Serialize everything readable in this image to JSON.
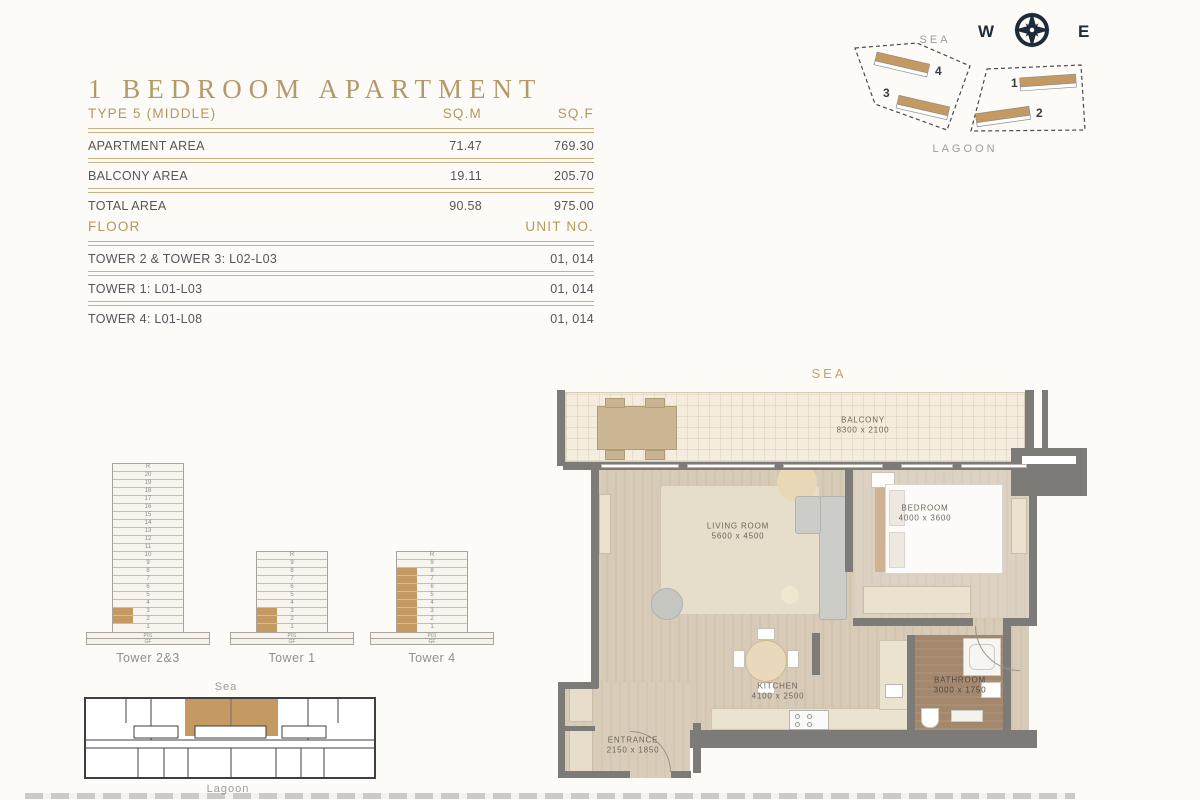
{
  "header": {
    "title": "1 BEDROOM APARTMENT",
    "area_table": {
      "type_label": "TYPE 5 (MIDDLE)",
      "col_sqm": "SQ.M",
      "col_sqf": "SQ.F",
      "rows": [
        {
          "label": "APARTMENT AREA",
          "sqm": "71.47",
          "sqf": "769.30"
        },
        {
          "label": "BALCONY AREA",
          "sqm": "19.11",
          "sqf": "205.70"
        },
        {
          "label": "TOTAL AREA",
          "sqm": "90.58",
          "sqf": "975.00"
        }
      ]
    },
    "floor_table": {
      "col_floor": "FLOOR",
      "col_unit": "UNIT NO.",
      "rows": [
        {
          "floor": "TOWER 2 & TOWER 3: L02-L03",
          "unit": "01, 014"
        },
        {
          "floor": "TOWER 1: L01-L03",
          "unit": "01, 014"
        },
        {
          "floor": "TOWER 4: L01-L08",
          "unit": "01, 014"
        }
      ]
    }
  },
  "compass": {
    "west": "W",
    "east": "E"
  },
  "site_plan": {
    "sea_label": "SEA",
    "lagoon_label": "LAGOON",
    "numbers": {
      "n1": "1",
      "n2": "2",
      "n3": "3",
      "n4": "4"
    }
  },
  "towers": [
    {
      "label": "Tower 2&3",
      "floors": [
        "R",
        "20",
        "19",
        "18",
        "17",
        "16",
        "15",
        "14",
        "13",
        "12",
        "11",
        "10",
        "9",
        "8",
        "7",
        "6",
        "5",
        "4",
        "3",
        "2",
        "1"
      ],
      "podium": [
        "P01",
        "GF"
      ],
      "highlighted": [
        "3",
        "2"
      ]
    },
    {
      "label": "Tower 1",
      "floors": [
        "R",
        "9",
        "8",
        "7",
        "6",
        "5",
        "4",
        "3",
        "2",
        "1"
      ],
      "podium": [
        "P01",
        "GF"
      ],
      "highlighted": [
        "3",
        "2",
        "1"
      ]
    },
    {
      "label": "Tower 4",
      "floors": [
        "R",
        "9",
        "8",
        "7",
        "6",
        "5",
        "4",
        "3",
        "2",
        "1"
      ],
      "podium": [
        "P01",
        "GF"
      ],
      "highlighted": [
        "8",
        "7",
        "6",
        "5",
        "4",
        "3",
        "2",
        "1"
      ]
    }
  ],
  "key_plan": {
    "sea_label": "Sea",
    "lagoon_label": "Lagoon"
  },
  "floor_plan": {
    "sea_label": "SEA",
    "rooms": [
      {
        "name": "BALCONY",
        "dims": "8300 x 2100"
      },
      {
        "name": "LIVING ROOM",
        "dims": "5600 x 4500"
      },
      {
        "name": "BEDROOM",
        "dims": "4000 x 3600"
      },
      {
        "name": "KITCHEN",
        "dims": "4100 x 2500"
      },
      {
        "name": "BATHROOM",
        "dims": "3000 x 1750"
      },
      {
        "name": "ENTRANCE",
        "dims": "2150 x 1850"
      }
    ]
  },
  "colors": {
    "gold": "#b6975d",
    "gold_line": "#cbb183",
    "text_dark": "#55555a",
    "text_gray": "#9c9c9c",
    "wall_gray": "#7d7b77",
    "floor_wood": "#d7cab6",
    "balcony_cream": "#f4edde",
    "bathroom_brown": "#a4886d",
    "highlight_tan": "#c49a62",
    "compass_navy": "#1e2b39"
  }
}
